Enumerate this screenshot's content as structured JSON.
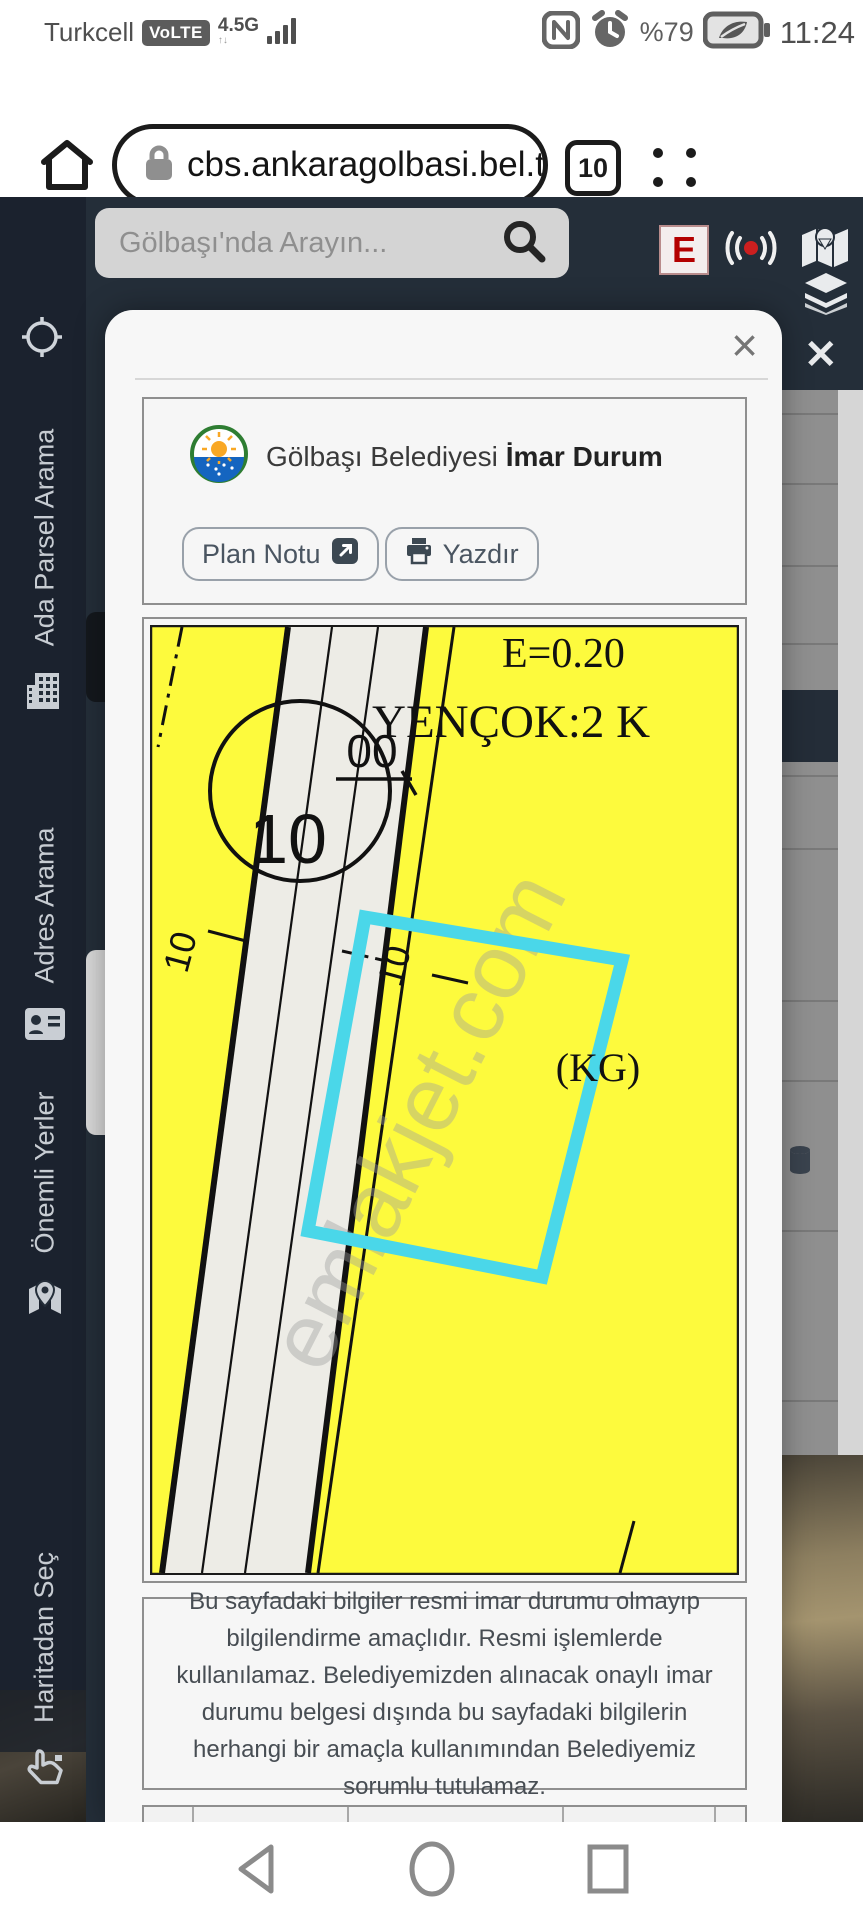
{
  "status_bar": {
    "carrier": "Turkcell",
    "volte_badge": "VoLTE",
    "network": "4.5G",
    "battery_percent": "%79",
    "time": "11:24",
    "icons": [
      "signal-bars-icon",
      "nfc-icon",
      "alarm-icon",
      "battery-saver-leaf-icon"
    ]
  },
  "browser_bar": {
    "url": "cbs.ankaragolbasi.bel.tr/(",
    "tab_count": "10",
    "icons": [
      "home-icon",
      "lock-icon",
      "menu-dots-icon"
    ]
  },
  "page_header": {
    "search_placeholder": "Gölbaşı'nda Arayın...",
    "pharmacy_badge": "E",
    "icons": [
      "search-icon",
      "broadcast-icon",
      "map-icon",
      "layers-icon"
    ]
  },
  "sidebar": {
    "items": [
      {
        "label": "Ada Parsel Arama",
        "icon": "building-icon"
      },
      {
        "label": "Adres Arama",
        "icon": "address-card-icon"
      },
      {
        "label": "Önemli Yerler",
        "icon": "map-marker-icon"
      },
      {
        "label": "Haritadan Seç",
        "icon": "hand-pointer-icon"
      }
    ],
    "top_icon": "crosshair-icon"
  },
  "right_panel": {
    "close_label": "✕"
  },
  "modal": {
    "close_label": "×",
    "title_regular": "Gölbaşı Belediyesi",
    "title_bold": "İmar Durum",
    "buttons": {
      "plan_notu": "Plan Notu",
      "yazdir": "Yazdır"
    },
    "map": {
      "label_e": "E=0.20",
      "label_yencok": "YENÇOK:2 K",
      "label_kg": "(KG)",
      "circle_top": "00",
      "circle_bottom": "10",
      "road_width_left": "10",
      "road_width_mid": "10",
      "watermark": "emlakjet.com"
    },
    "disclaimer": "Bu sayfadaki bilgiler resmi imar durumu olmayıp bilgilendirme amaçlıdır. Resmi işlemlerde kullanılamaz. Belediyemizden alınacak onaylı imar durumu belgesi dışında bu sayfadaki bilgilerin herhangi bir amaçla kullanımından Belediyemiz sorumlu tutulamaz."
  },
  "colors": {
    "zone_yellow": "#fdfa3d",
    "parcel_cyan": "#4ad7e9",
    "road_fill": "#edece6",
    "page_dark": "#242e39",
    "pharmacy_red": "#b30000",
    "accent_record_red": "#cc1f1f"
  }
}
